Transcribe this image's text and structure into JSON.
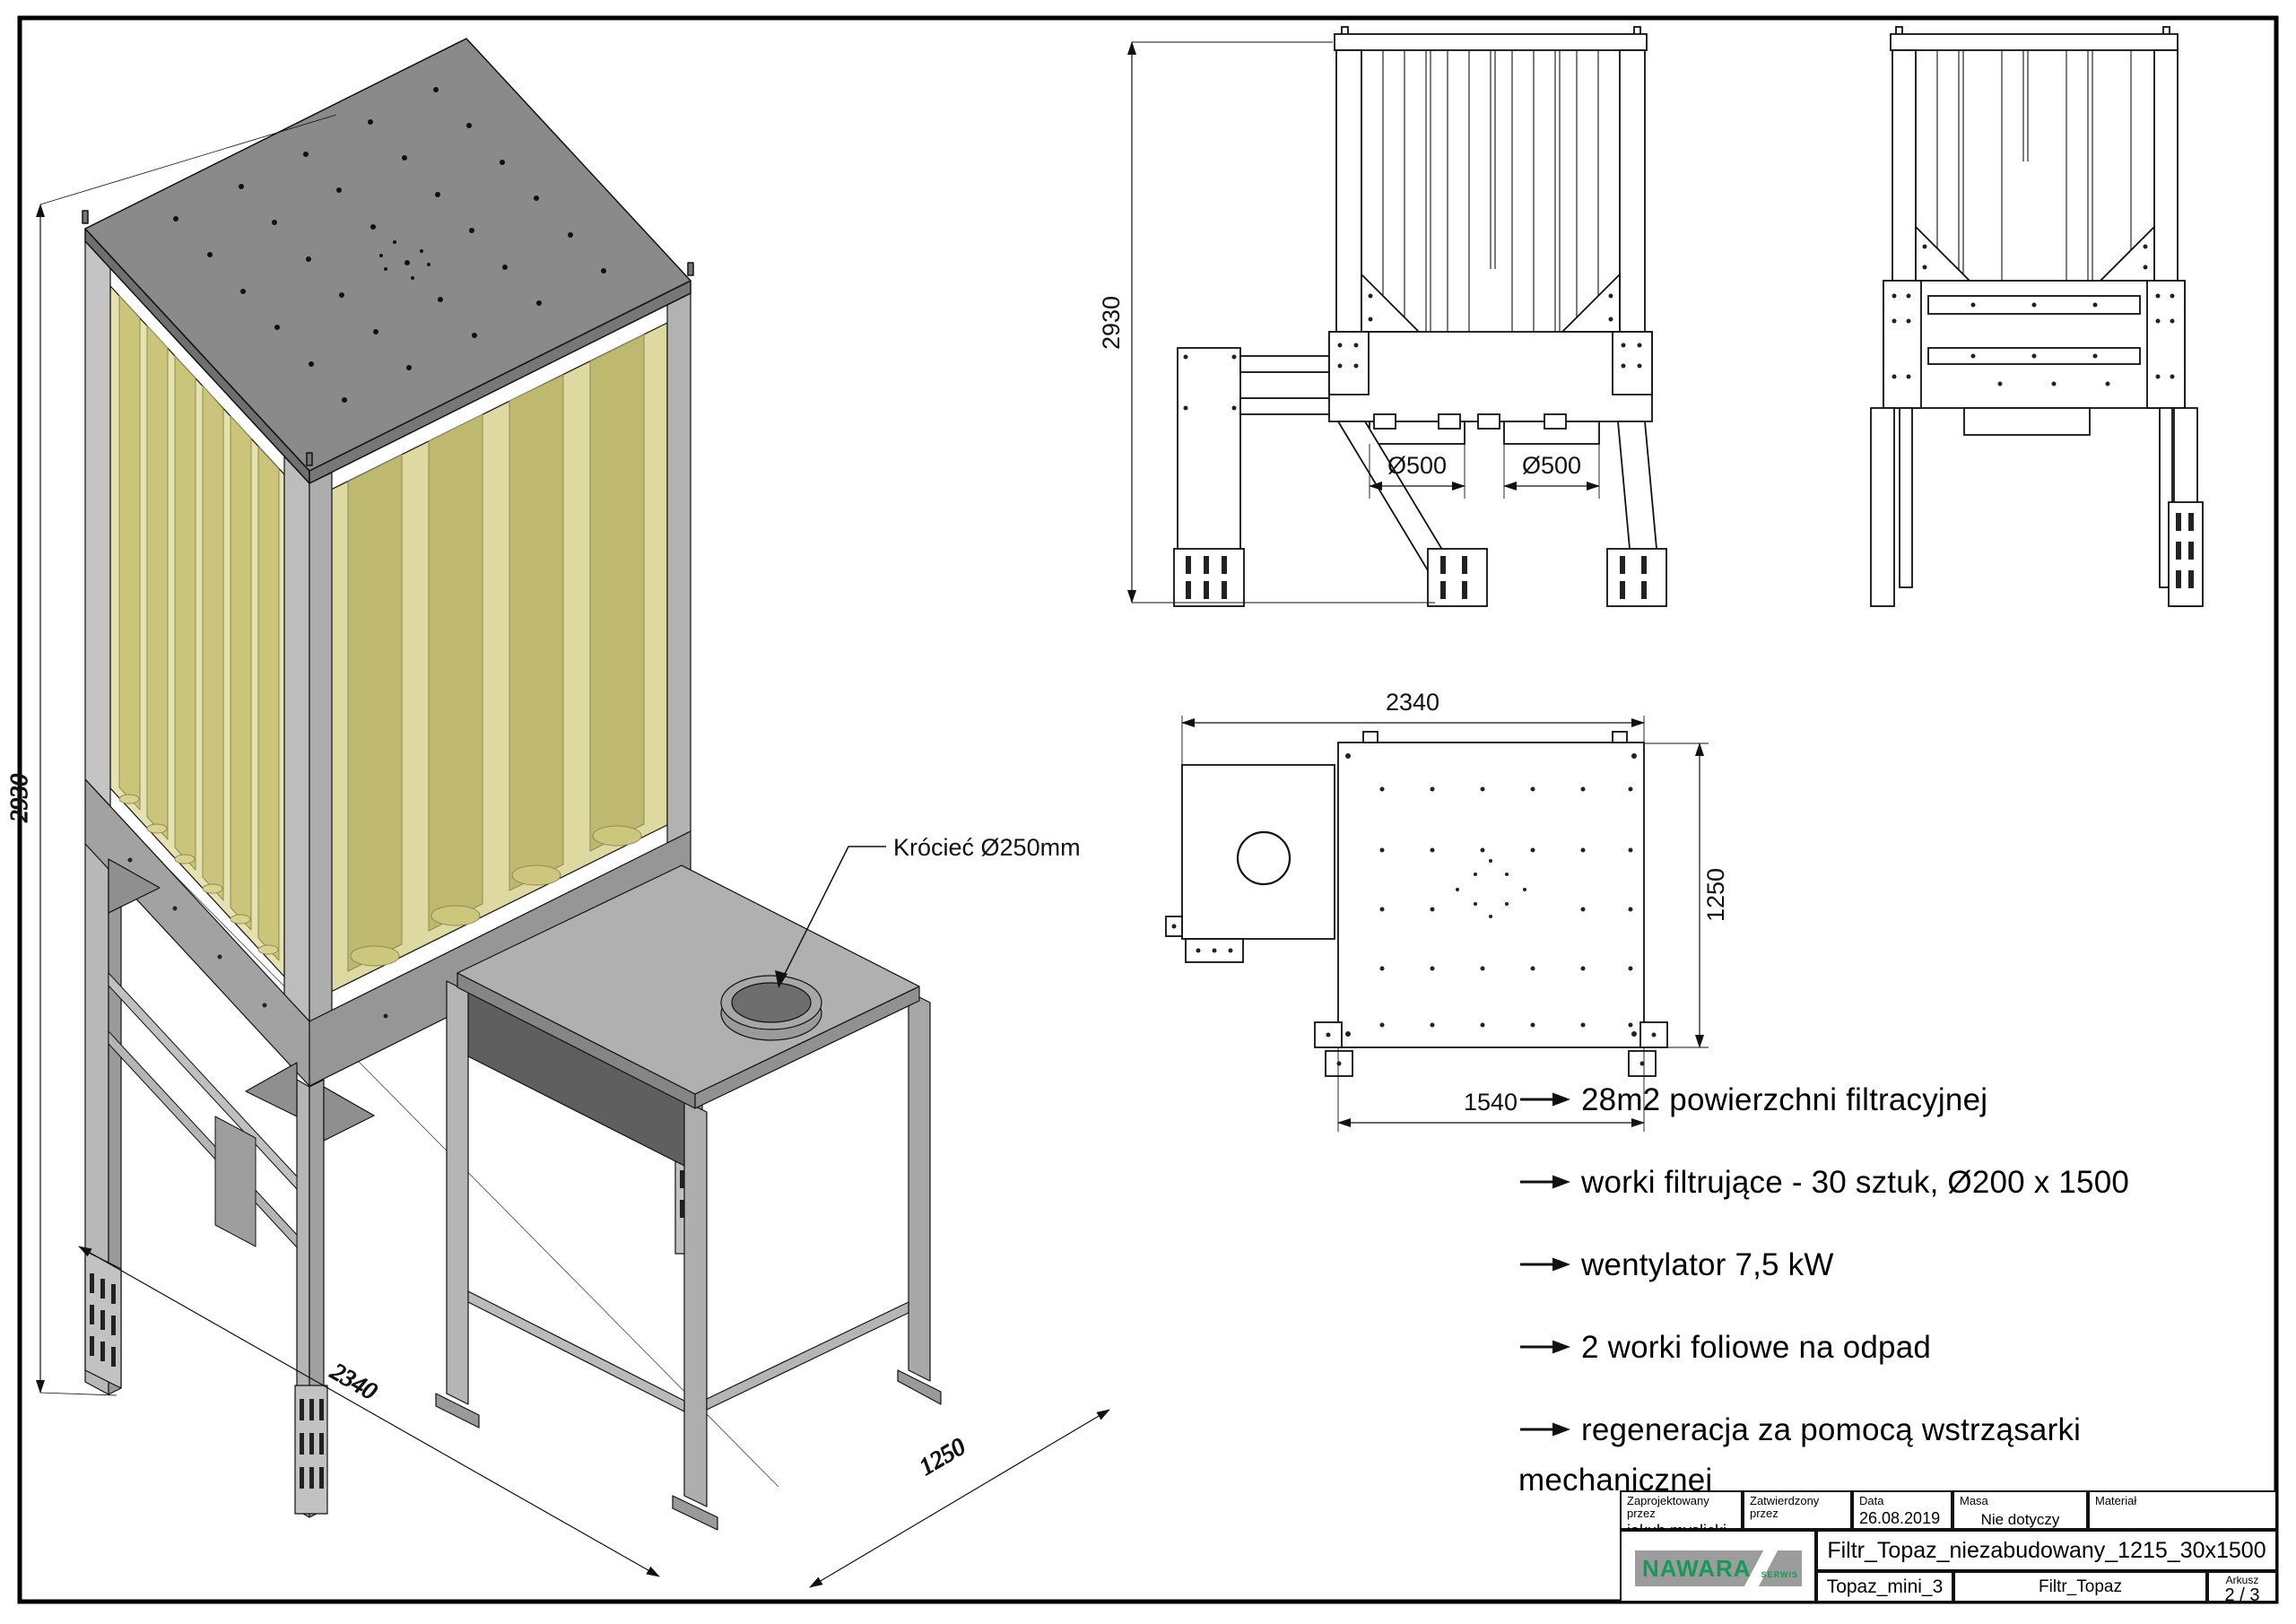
{
  "sheet": {
    "background": "#ffffff",
    "border_color": "#000000"
  },
  "colors": {
    "logo_green": "#159a58",
    "logo_gray": "#9c9c9c",
    "bag_yellow": "#cbc57b",
    "steel_gray": "#a9a9a9",
    "plate_gray": "#8a8a8a"
  },
  "iso_view": {
    "dim_height": "2930",
    "dim_width": "2340",
    "dim_depth": "1250",
    "port_annotation": "Krócieć Ø250mm"
  },
  "front_view": {
    "dim_height": "2930",
    "dim_outlet_left": "Ø500",
    "dim_outlet_right": "Ø500"
  },
  "top_view": {
    "dim_total_width": "2340",
    "dim_plate_width": "1540",
    "dim_depth": "1250"
  },
  "specs": {
    "items": [
      "28m2 powierzchni filtracyjnej",
      "worki filtrujące - 30 sztuk, Ø200 x 1500",
      "wentylator 7,5 kW",
      "2 worki foliowe na odpad",
      "regeneracja za pomocą wstrząsarki mechanicznej"
    ]
  },
  "title_block": {
    "designed_by_label": "Zaprojektowany przez",
    "designed_by": "jakub.myslicki",
    "approved_by_label": "Zatwierdzony przez",
    "approved_by": "",
    "date_label": "Data",
    "date": "26.08.2019",
    "mass_label": "Masa",
    "mass": "Nie dotyczy",
    "material_label": "Materiał",
    "material": "",
    "drawing_title": "Filtr_Topaz_niezabudowany_1215_30x1500",
    "model_name": "Topaz_mini_3",
    "part_name": "Filtr_Topaz",
    "sheet_label": "Arkusz",
    "sheet_number": "2 / 3",
    "logo_text": "NAWARA",
    "logo_subtext": "SERWIS"
  }
}
